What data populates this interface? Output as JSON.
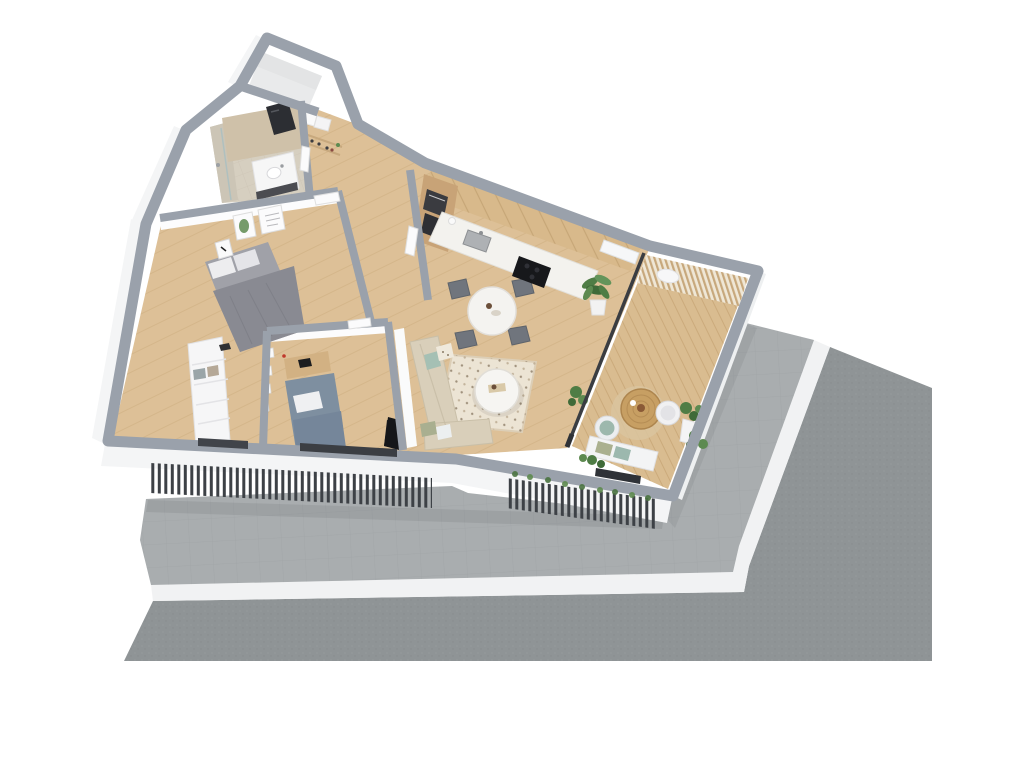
{
  "scene": {
    "title": "3D floor plan rendering of an apartment with balcony",
    "view": "axonometric top-down cutaway",
    "rooms": [
      "entrance-stairwell",
      "bathroom",
      "entry-closet",
      "hallway",
      "bedroom",
      "kids-bedroom",
      "kitchen",
      "dining-area",
      "living-area",
      "balcony"
    ],
    "exterior": [
      "paved-walkway",
      "white-curb",
      "asphalt-street",
      "slatted-railing",
      "white-facade"
    ],
    "furniture": {
      "bathroom": [
        "vanity-sink",
        "mirror",
        "shower"
      ],
      "entry-closet": [
        "storage-boxes",
        "shoe-shelf"
      ],
      "bedroom": [
        "double-bed",
        "wardrobe",
        "wall-posters",
        "bedside-cube"
      ],
      "kids-bedroom": [
        "single-bed",
        "desk",
        "wall-frames",
        "floor-lamp"
      ],
      "kitchen": [
        "wood-cabinets",
        "tall-oven-column",
        "counter",
        "sink",
        "cooktop",
        "potted-plant",
        "radiator"
      ],
      "dining-area": [
        "round-table",
        "four-chairs"
      ],
      "living-area": [
        "corner-sofa",
        "coffee-table",
        "patterned-rug",
        "tv"
      ],
      "balcony": [
        "slatted-screen",
        "rattan-table",
        "round-chairs",
        "bench",
        "planters",
        "glass-sliding-door"
      ]
    }
  },
  "palette": {
    "background": "#ffffff",
    "wall_top": "#9aa1ab",
    "wall_face": "#f4f5f6",
    "wood_floor": "#ddc097",
    "bathroom_tile": "#d6cfc0",
    "deck_wood": "#d9bc90",
    "walkway": "#a9adaf",
    "curb": "#f1f2f3",
    "asphalt": "#8f9496",
    "slat_dark": "#3d4146",
    "glass_frame": "#3a3d42",
    "bed_gray": "#a0a1a8",
    "blanket_gray": "#898a92",
    "pillow_white": "#ededef",
    "bed_blue": "#7e8fa0",
    "sofa_beige": "#d9cfba",
    "rug_cream": "#ece4d4",
    "dining_table": "#f4f3f0",
    "chair_gray": "#70757d",
    "cabinet_wood": "#d8b98b",
    "counter_white": "#f3f2ee",
    "cooktop_black": "#17181b",
    "plant_green": "#4f7d45",
    "rattan": "#c79f63",
    "tv_black": "#151619",
    "wardrobe_white": "#f6f6f7",
    "poster_white": "#fbfbfc",
    "screen_base": "#efe7d6",
    "screen_slat": "#c7a87c"
  }
}
